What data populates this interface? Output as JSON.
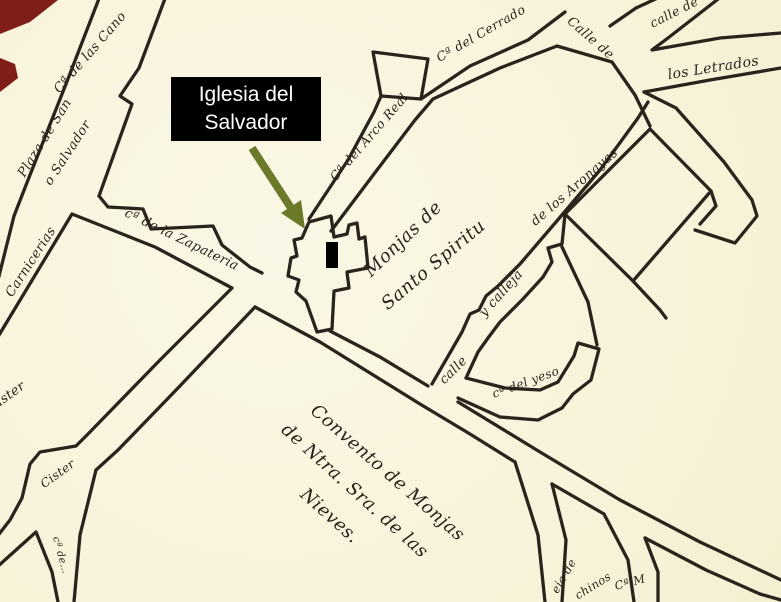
{
  "callout": {
    "line1": "Iglesia del",
    "line2": "Salvador",
    "bg_color": "#000000",
    "text_color": "#ffffff",
    "arrow_color": "#6b7a28",
    "marker_color": "#000000"
  },
  "map": {
    "paper_color": "#f8f3da",
    "ink_color": "#2b241d",
    "red_accent_color": "#7f1d17",
    "labels": [
      {
        "id": "canongias-partial",
        "text": "Cª de las Cano"
      },
      {
        "id": "plaza-line1",
        "text": "Plaza de San"
      },
      {
        "id": "plaza-line2",
        "text": "o Salvador"
      },
      {
        "id": "carnicerias",
        "text": "Carnicerias"
      },
      {
        "id": "zapateria",
        "text": "cª de la Zapateria"
      },
      {
        "id": "arco-real",
        "text": "Cª del Arco Real"
      },
      {
        "id": "cerrado",
        "text": "Cª del Cerrado"
      },
      {
        "id": "calle-top-right-partial",
        "text": "calle de"
      },
      {
        "id": "letrados-1",
        "text": "Calle de"
      },
      {
        "id": "letrados-2",
        "text": "los Letrados"
      },
      {
        "id": "aronayas",
        "text": "de los Aronayas"
      },
      {
        "id": "y-calleja",
        "text": "y calleja"
      },
      {
        "id": "calle",
        "text": "calle"
      },
      {
        "id": "yeso",
        "text": "cª del yeso"
      },
      {
        "id": "monjas-line1",
        "text": "Monjas de"
      },
      {
        "id": "monjas-line2",
        "text": "Santo Spiritu"
      },
      {
        "id": "convento-line1",
        "text": "Convento de Monjas"
      },
      {
        "id": "convento-line2",
        "text": "de Ntra. Sra. de las"
      },
      {
        "id": "convento-line3",
        "text": "Nieves."
      },
      {
        "id": "cister",
        "text": "Cister"
      },
      {
        "id": "ister-partial",
        "text": "ister"
      },
      {
        "id": "illegible-street",
        "text": "cª de…"
      },
      {
        "id": "eja-de-partial",
        "text": "eja de"
      },
      {
        "id": "chinos-partial",
        "text": "chinos"
      },
      {
        "id": "ca-m-partial",
        "text": "Cª M"
      }
    ]
  }
}
